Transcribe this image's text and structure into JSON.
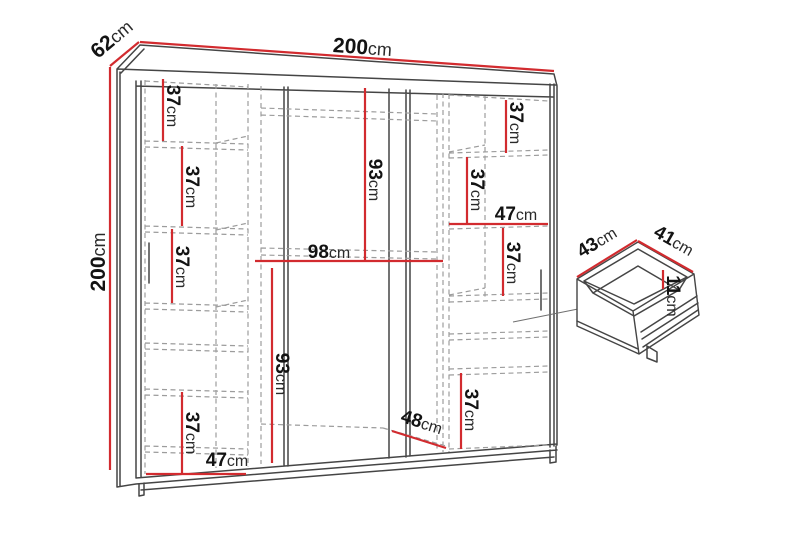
{
  "figure": {
    "type": "furniture-dimension-diagram",
    "subject": "three-door wardrobe with interior shelving and drawer detail",
    "background": "#ffffff"
  },
  "colors": {
    "dimension_line": "#d22b2f",
    "outline": "#454545",
    "hidden_line": "#9c9c9c",
    "label_text": "#131313"
  },
  "dims": {
    "width": {
      "value": "200",
      "unit": "cm"
    },
    "depth": {
      "value": "62",
      "unit": "cm"
    },
    "height": {
      "value": "200",
      "unit": "cm"
    },
    "left_shelf1": {
      "value": "37",
      "unit": "cm"
    },
    "left_shelf2": {
      "value": "37",
      "unit": "cm"
    },
    "left_shelf3": {
      "value": "37",
      "unit": "cm"
    },
    "left_shelf4": {
      "value": "37",
      "unit": "cm"
    },
    "left_width": {
      "value": "47",
      "unit": "cm"
    },
    "mid_height_upper": {
      "value": "93",
      "unit": "cm"
    },
    "mid_width": {
      "value": "98",
      "unit": "cm"
    },
    "mid_height_lower": {
      "value": "93",
      "unit": "cm"
    },
    "mid_depth": {
      "value": "48",
      "unit": "cm"
    },
    "right_shelf1": {
      "value": "37",
      "unit": "cm"
    },
    "right_shelf2": {
      "value": "37",
      "unit": "cm"
    },
    "right_width": {
      "value": "47",
      "unit": "cm"
    },
    "right_shelf3": {
      "value": "37",
      "unit": "cm"
    },
    "right_shelf4": {
      "value": "37",
      "unit": "cm"
    },
    "drawer_depth": {
      "value": "43",
      "unit": "cm"
    },
    "drawer_width": {
      "value": "41",
      "unit": "cm"
    },
    "drawer_height": {
      "value": "11",
      "unit": "cm"
    }
  }
}
